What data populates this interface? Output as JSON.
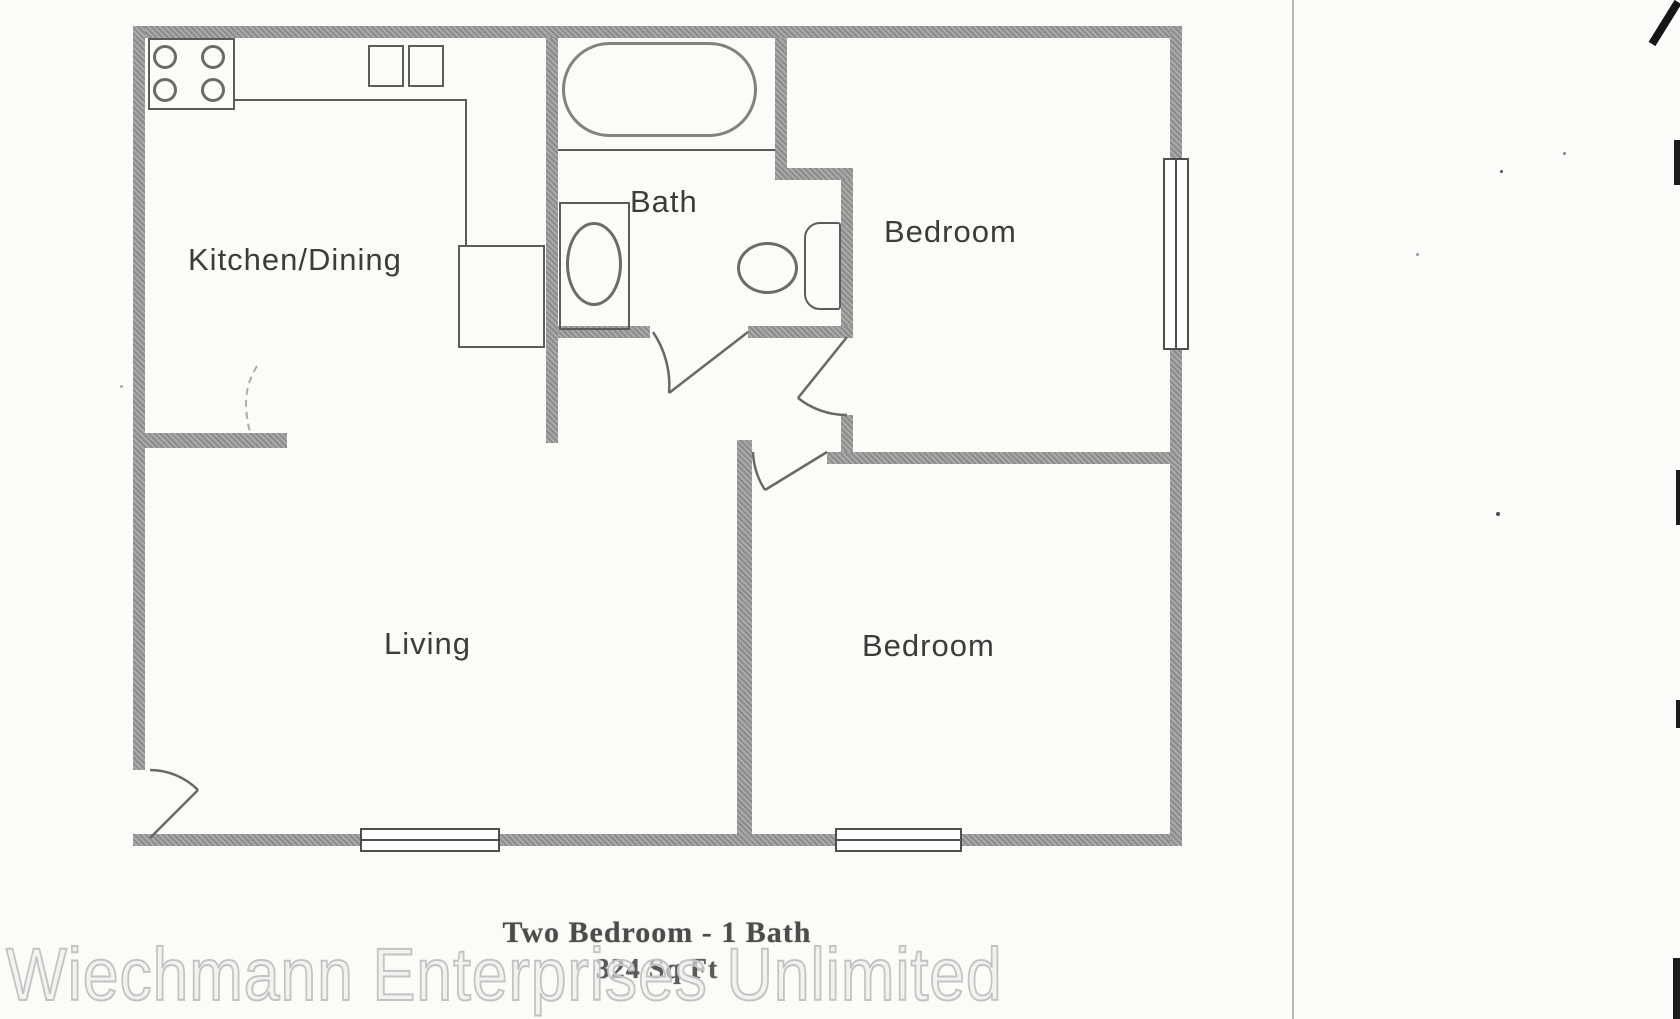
{
  "page": {
    "rooms": {
      "kitchen": {
        "label": "Kitchen/Dining"
      },
      "bath": {
        "label": "Bath"
      },
      "bedroom_top": {
        "label": "Bedroom"
      },
      "living": {
        "label": "Living"
      },
      "bedroom_bottom": {
        "label": "Bedroom"
      }
    },
    "caption": {
      "title": "Two Bedroom - 1 Bath",
      "area": "324 Sq Ft"
    },
    "watermark": "Wiechmann Enterprises Unlimited",
    "fixtures": [
      "stove",
      "kitchen-sink",
      "refrigerator",
      "bathtub",
      "vanity-sink",
      "toilet"
    ],
    "colors": {
      "wall": "#9d9d9d",
      "fixture_line": "#5c5c5c",
      "room_label": "#3c3c3c",
      "caption_text": "#4c4c4c",
      "watermark_stroke": "#c3c3c3",
      "page_background": "#fbfbf8"
    }
  }
}
